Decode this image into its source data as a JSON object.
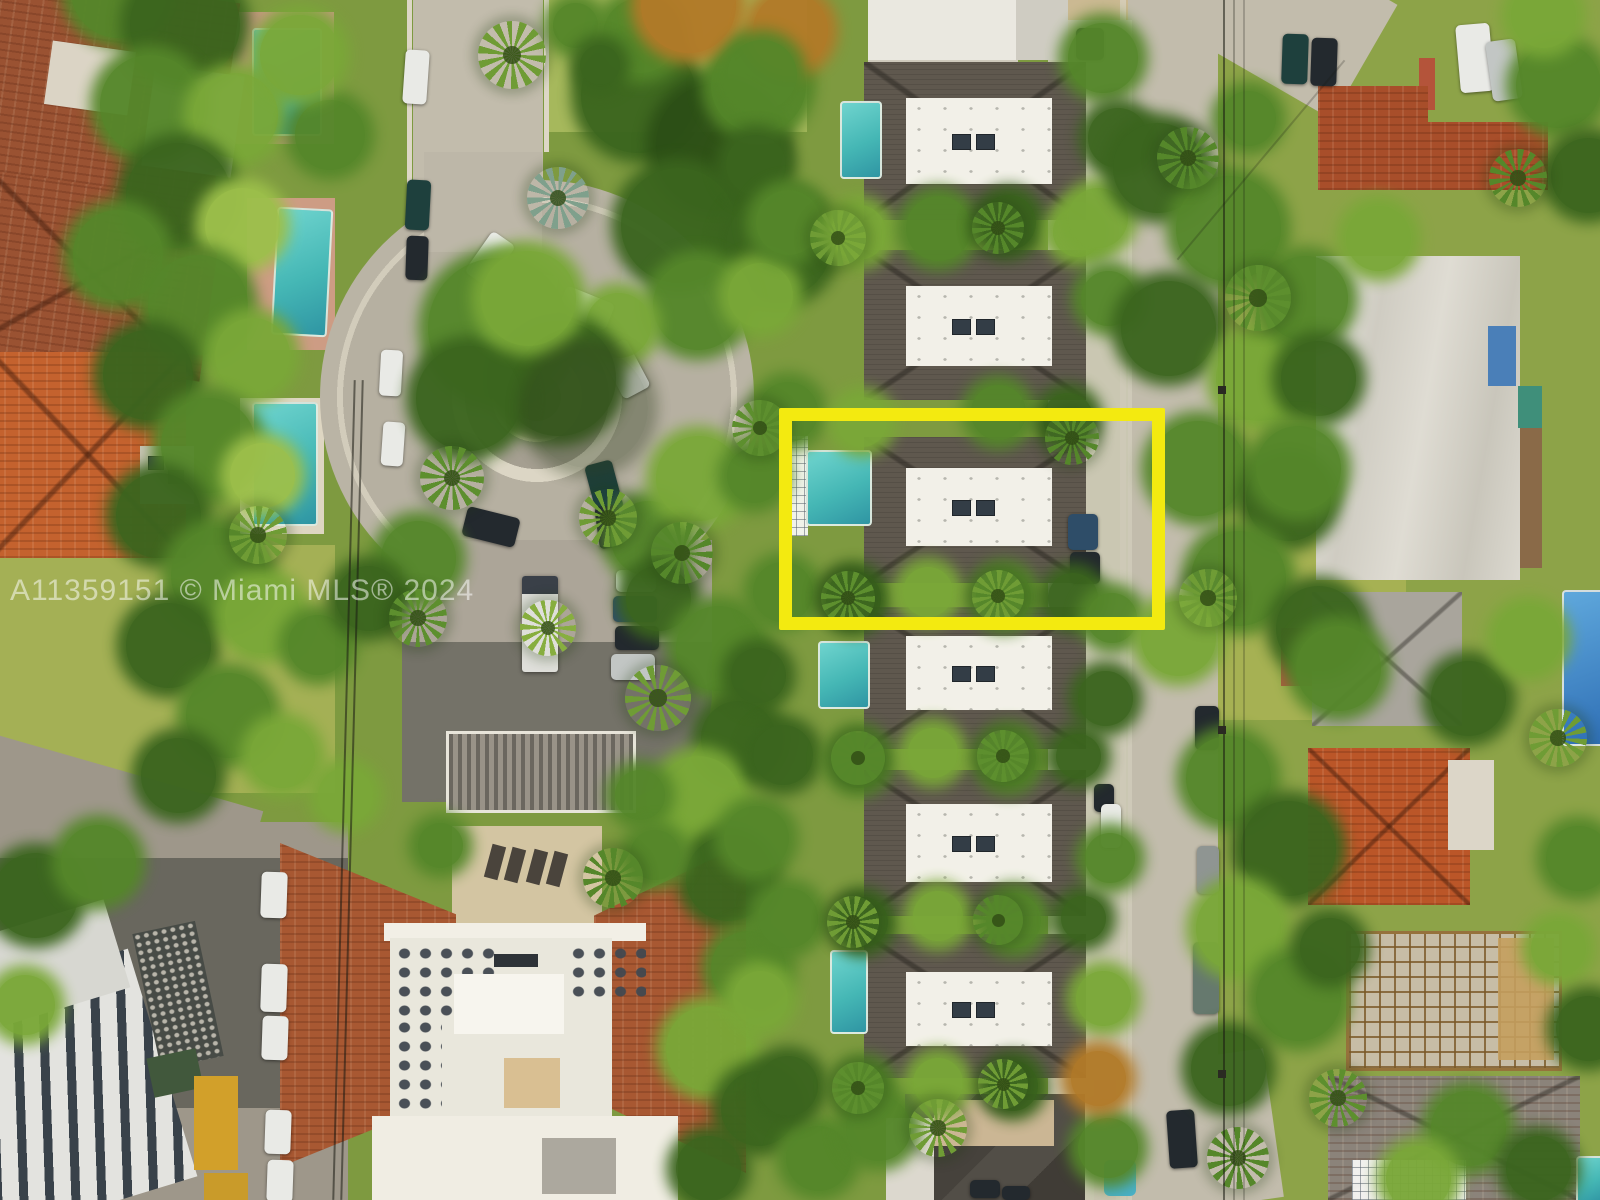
{
  "watermark": {
    "text": "A11359151 © Miami MLS® 2024"
  },
  "highlight_box": {
    "shape": "rectangle",
    "color": "#F3EA10"
  },
  "palette": {
    "highlight_yellow": "#F3EA10",
    "pool_teal": "#45B7B5",
    "terracotta": "#A85832",
    "bright_orange_roof": "#C4622E",
    "modern_roof": "#5F584E",
    "flat_roof_white": "#F2F0E8",
    "road_concrete": "#C2BCAC",
    "asphalt": "#9E978A",
    "grass_green": "#9FAC52",
    "foliage_dark": "#3B651E",
    "foliage_mid": "#55872A",
    "foliage_light": "#7AA838"
  }
}
